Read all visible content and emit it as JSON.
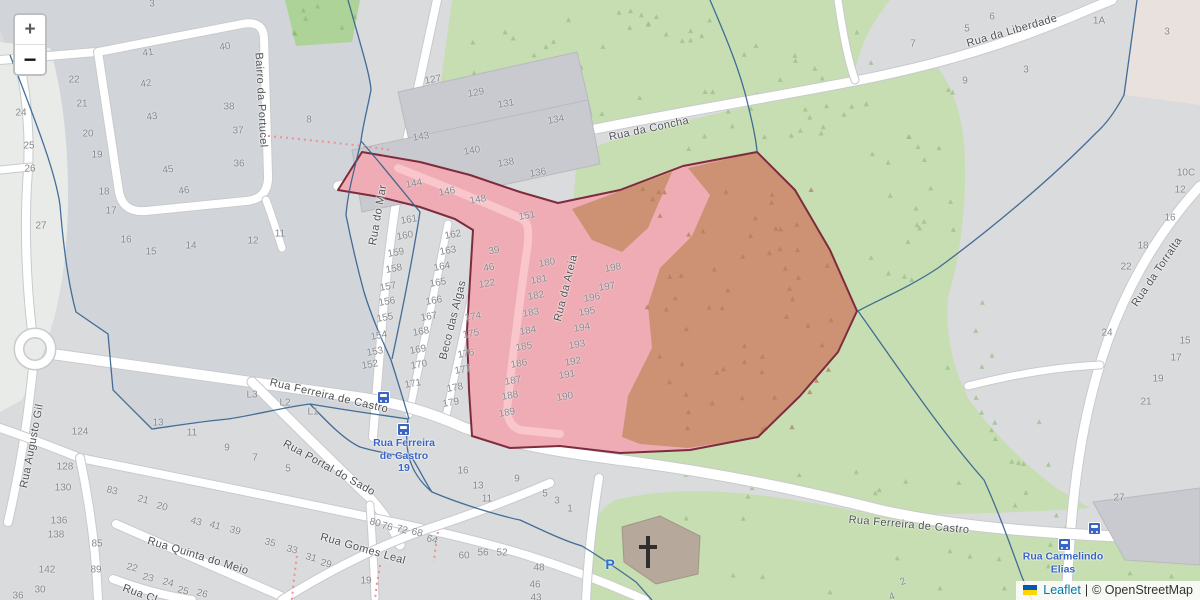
{
  "map": {
    "controls": {
      "zoom_in": "+",
      "zoom_out": "−"
    },
    "attribution": {
      "flag": "ukraine-flag",
      "leaflet": "Leaflet",
      "separator": "|",
      "osm": "© OpenStreetMap"
    },
    "colors": {
      "base": "#d9dbdd",
      "tint": "#d1d5da",
      "grass": "#c6deb2",
      "grass_dark": "#aed398",
      "highlight_pink": "#efacb5",
      "highlight_forest": "#cd9173",
      "highlight_border": "#7d2c3e",
      "boundary_blue": "#33618f",
      "road": "#ffffff",
      "building": "#c8cacf",
      "church": "#b6a89a",
      "transit_blue": "#3b65c5",
      "path_red": "#ee8f98"
    },
    "street_labels": [
      {
        "t": "Bairro da Portucel",
        "x": 261,
        "y": 100,
        "r": 87
      },
      {
        "t": "Rua do Mar",
        "x": 378,
        "y": 215,
        "r": -80
      },
      {
        "t": "Beco das Algas",
        "x": 453,
        "y": 320,
        "r": -76
      },
      {
        "t": "Rua da Areia",
        "x": 566,
        "y": 288,
        "r": -76
      },
      {
        "t": "Rua da Concha",
        "x": 649,
        "y": 129,
        "r": -12
      },
      {
        "t": "Rua da Liberdade",
        "x": 1012,
        "y": 31,
        "r": -16
      },
      {
        "t": "Rua da Torralta",
        "x": 1157,
        "y": 272,
        "r": -56
      },
      {
        "t": "Rua Ferreira de Castro",
        "x": 329,
        "y": 396,
        "r": 13
      },
      {
        "t": "Rua Ferreira de Castro",
        "x": 909,
        "y": 525,
        "r": 5
      },
      {
        "t": "Rua Portal do Sado",
        "x": 329,
        "y": 468,
        "r": 29
      },
      {
        "t": "Rua Gomes Leal",
        "x": 363,
        "y": 549,
        "r": 16
      },
      {
        "t": "Rua Quinta do Meio",
        "x": 198,
        "y": 556,
        "r": 17
      },
      {
        "t": "Rua Cl",
        "x": 140,
        "y": 594,
        "r": 20
      },
      {
        "t": "Rua Augusto Gil",
        "x": 32,
        "y": 446,
        "r": -79
      }
    ],
    "transit_labels": [
      {
        "lines": [
          "Rua Ferreira",
          "de Castro",
          "19"
        ],
        "x": 404,
        "y": 456
      },
      {
        "lines": [
          "Rua Carmelindo",
          "Elias"
        ],
        "x": 1063,
        "y": 563
      }
    ],
    "bus_stops": [
      {
        "x": 383,
        "y": 397
      },
      {
        "x": 403,
        "y": 429
      },
      {
        "x": 1094,
        "y": 528
      },
      {
        "x": 1064,
        "y": 544
      }
    ],
    "parking": {
      "label": "P",
      "x": 610,
      "y": 564
    },
    "church": {
      "x": 648,
      "y": 552
    },
    "house_numbers": [
      [
        "3",
        152,
        4,
        0
      ],
      [
        "40",
        225,
        47,
        -8
      ],
      [
        "41",
        148,
        53,
        -8
      ],
      [
        "42",
        146,
        84,
        -8
      ],
      [
        "22",
        74,
        80,
        0
      ],
      [
        "21",
        82,
        104,
        0
      ],
      [
        "24",
        21,
        113,
        0
      ],
      [
        "38",
        229,
        107,
        0
      ],
      [
        "43",
        152,
        117,
        -8
      ],
      [
        "37",
        238,
        131,
        0
      ],
      [
        "20",
        88,
        134,
        0
      ],
      [
        "25",
        29,
        146,
        0
      ],
      [
        "19",
        97,
        155,
        0
      ],
      [
        "26",
        30,
        169,
        0
      ],
      [
        "45",
        168,
        170,
        -8
      ],
      [
        "36",
        239,
        164,
        0
      ],
      [
        "46",
        184,
        191,
        -8
      ],
      [
        "18",
        104,
        192,
        0
      ],
      [
        "17",
        111,
        211,
        0
      ],
      [
        "27",
        41,
        226,
        0
      ],
      [
        "16",
        126,
        240,
        0
      ],
      [
        "15",
        151,
        252,
        0
      ],
      [
        "14",
        191,
        246,
        0
      ],
      [
        "12",
        253,
        241,
        0
      ],
      [
        "11",
        280,
        234,
        0
      ],
      [
        "8",
        309,
        120,
        0
      ],
      [
        "127",
        433,
        80,
        -10
      ],
      [
        "129",
        476,
        93,
        -10
      ],
      [
        "131",
        506,
        104,
        -10
      ],
      [
        "134",
        556,
        120,
        -10
      ],
      [
        "143",
        421,
        137,
        -10
      ],
      [
        "140",
        472,
        151,
        -10
      ],
      [
        "138",
        506,
        163,
        -10
      ],
      [
        "136",
        538,
        173,
        -10
      ],
      [
        "144",
        414,
        184,
        -10
      ],
      [
        "146",
        447,
        192,
        -10
      ],
      [
        "148",
        478,
        200,
        -10
      ],
      [
        "151",
        527,
        216,
        -10
      ],
      [
        "161",
        409,
        220,
        -10
      ],
      [
        "160",
        405,
        236,
        -10
      ],
      [
        "159",
        396,
        253,
        -10
      ],
      [
        "158",
        394,
        269,
        -10
      ],
      [
        "157",
        388,
        287,
        -10
      ],
      [
        "156",
        387,
        302,
        -10
      ],
      [
        "155",
        385,
        318,
        -10
      ],
      [
        "154",
        379,
        336,
        -10
      ],
      [
        "153",
        375,
        352,
        -10
      ],
      [
        "152",
        370,
        365,
        -10
      ],
      [
        "162",
        453,
        235,
        -10
      ],
      [
        "163",
        448,
        251,
        -10
      ],
      [
        "164",
        442,
        267,
        -10
      ],
      [
        "165",
        438,
        283,
        -10
      ],
      [
        "166",
        434,
        301,
        -10
      ],
      [
        "167",
        429,
        317,
        -10
      ],
      [
        "168",
        421,
        332,
        -10
      ],
      [
        "169",
        418,
        350,
        -10
      ],
      [
        "170",
        419,
        365,
        -10
      ],
      [
        "171",
        413,
        384,
        -10
      ],
      [
        "39",
        494,
        251,
        -10
      ],
      [
        "46",
        489,
        268,
        -10
      ],
      [
        "122",
        487,
        284,
        -10
      ],
      [
        "174",
        473,
        317,
        -10
      ],
      [
        "175",
        471,
        334,
        -10
      ],
      [
        "176",
        466,
        354,
        -10
      ],
      [
        "177",
        463,
        370,
        -10
      ],
      [
        "178",
        455,
        388,
        -10
      ],
      [
        "179",
        451,
        403,
        -10
      ],
      [
        "180",
        547,
        263,
        -10
      ],
      [
        "181",
        539,
        280,
        -10
      ],
      [
        "182",
        536,
        296,
        -10
      ],
      [
        "183",
        531,
        313,
        -10
      ],
      [
        "184",
        528,
        331,
        -10
      ],
      [
        "185",
        524,
        347,
        -10
      ],
      [
        "186",
        519,
        364,
        -10
      ],
      [
        "187",
        513,
        381,
        -10
      ],
      [
        "188",
        510,
        396,
        -10
      ],
      [
        "189",
        507,
        413,
        -10
      ],
      [
        "198",
        613,
        268,
        -10
      ],
      [
        "197",
        607,
        287,
        -10
      ],
      [
        "196",
        592,
        298,
        -10
      ],
      [
        "195",
        587,
        312,
        -10
      ],
      [
        "194",
        582,
        328,
        -10
      ],
      [
        "193",
        577,
        345,
        -10
      ],
      [
        "192",
        573,
        362,
        -10
      ],
      [
        "191",
        567,
        375,
        -10
      ],
      [
        "190",
        565,
        397,
        -10
      ],
      [
        "16",
        463,
        471,
        0
      ],
      [
        "13",
        478,
        486,
        0
      ],
      [
        "11",
        487,
        499,
        0
      ],
      [
        "9",
        517,
        479,
        0
      ],
      [
        "5",
        545,
        494,
        0
      ],
      [
        "3",
        557,
        501,
        0
      ],
      [
        "1",
        570,
        509,
        0
      ],
      [
        "L3",
        252,
        395,
        0
      ],
      [
        "L2",
        285,
        403,
        0
      ],
      [
        "L1",
        313,
        412,
        0
      ],
      [
        "124",
        80,
        432,
        0
      ],
      [
        "13",
        158,
        423,
        0
      ],
      [
        "11",
        192,
        433,
        0
      ],
      [
        "9",
        227,
        448,
        0
      ],
      [
        "7",
        255,
        458,
        0
      ],
      [
        "5",
        288,
        469,
        0
      ],
      [
        "128",
        65,
        467,
        0
      ],
      [
        "130",
        63,
        488,
        0
      ],
      [
        "83",
        112,
        491,
        15
      ],
      [
        "21",
        143,
        500,
        15
      ],
      [
        "20",
        162,
        507,
        15
      ],
      [
        "136",
        59,
        521,
        0
      ],
      [
        "138",
        56,
        535,
        0
      ],
      [
        "43",
        196,
        522,
        15
      ],
      [
        "41",
        215,
        526,
        15
      ],
      [
        "39",
        235,
        531,
        15
      ],
      [
        "35",
        270,
        543,
        15
      ],
      [
        "33",
        292,
        550,
        15
      ],
      [
        "85",
        97,
        544,
        0
      ],
      [
        "142",
        47,
        570,
        0
      ],
      [
        "89",
        96,
        570,
        0
      ],
      [
        "22",
        132,
        568,
        15
      ],
      [
        "30",
        40,
        590,
        0
      ],
      [
        "36",
        18,
        596,
        0
      ],
      [
        "23",
        148,
        578,
        15
      ],
      [
        "24",
        168,
        583,
        15
      ],
      [
        "25",
        183,
        591,
        15
      ],
      [
        "26",
        202,
        594,
        15
      ],
      [
        "31",
        311,
        558,
        15
      ],
      [
        "29",
        326,
        564,
        15
      ],
      [
        "19",
        366,
        581,
        0
      ],
      [
        "80",
        375,
        523,
        15
      ],
      [
        "76",
        387,
        527,
        15
      ],
      [
        "72",
        402,
        530,
        15
      ],
      [
        "68",
        417,
        533,
        15
      ],
      [
        "64",
        432,
        540,
        15
      ],
      [
        "60",
        464,
        556,
        0
      ],
      [
        "56",
        483,
        553,
        0
      ],
      [
        "52",
        502,
        553,
        0
      ],
      [
        "48",
        539,
        568,
        0
      ],
      [
        "46",
        535,
        585,
        0
      ],
      [
        "43",
        536,
        598,
        0
      ],
      [
        "27",
        1119,
        498,
        0
      ],
      [
        "2",
        903,
        582,
        -20
      ],
      [
        "4",
        892,
        597,
        -20
      ],
      [
        "10C",
        1186,
        173,
        0
      ],
      [
        "12",
        1180,
        190,
        0
      ],
      [
        "16",
        1170,
        218,
        0
      ],
      [
        "18",
        1143,
        246,
        0
      ],
      [
        "22",
        1126,
        267,
        0
      ],
      [
        "24",
        1107,
        333,
        0
      ],
      [
        "15",
        1185,
        341,
        0
      ],
      [
        "17",
        1176,
        358,
        0
      ],
      [
        "19",
        1158,
        379,
        0
      ],
      [
        "21",
        1146,
        402,
        0
      ],
      [
        "7",
        913,
        44,
        0
      ],
      [
        "5",
        967,
        29,
        0
      ],
      [
        "6",
        992,
        17,
        0
      ],
      [
        "9",
        965,
        81,
        0
      ],
      [
        "3",
        1026,
        70,
        0
      ],
      [
        "1A",
        1099,
        21,
        0
      ],
      [
        "3",
        1167,
        32,
        0
      ]
    ]
  }
}
